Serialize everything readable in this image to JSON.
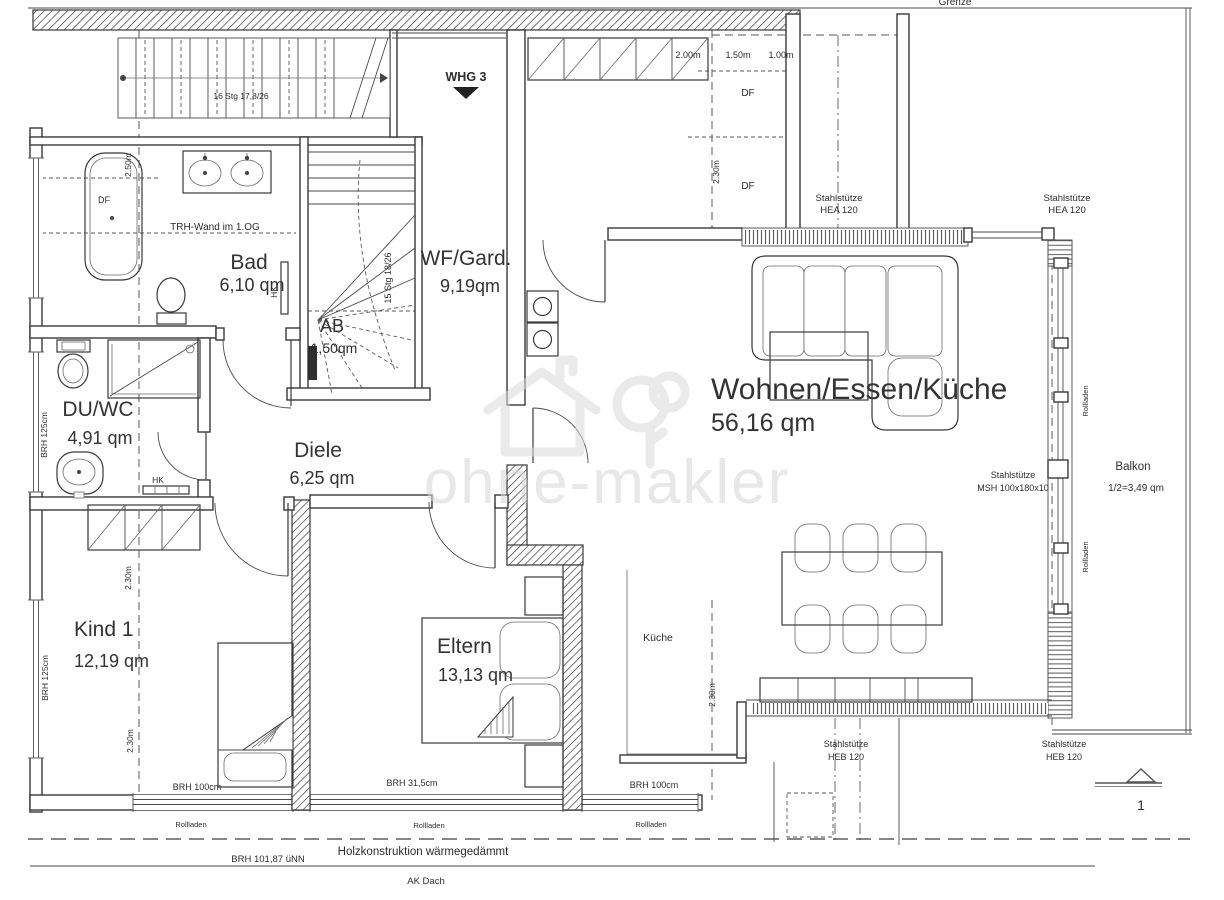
{
  "watermark": "ohne-makler",
  "entrance": {
    "label": "WHG 3"
  },
  "site": {
    "grenze": "Grenze"
  },
  "rooms": {
    "bad": {
      "name": "Bad",
      "area": "6,10 qm"
    },
    "wf_gard": {
      "name": "WF/Gard.",
      "area": "9,19qm"
    },
    "ab": {
      "name": "AB",
      "area": "1,50qm"
    },
    "du_wc": {
      "name": "DU/WC",
      "area": "4,91 qm"
    },
    "diele": {
      "name": "Diele",
      "area": "6,25 qm"
    },
    "wohnen_essen_kueche": {
      "name": "Wohnen/Essen/Küche",
      "area": "56,16 qm"
    },
    "kueche": {
      "name": "Küche"
    },
    "kind1": {
      "name": "Kind 1",
      "area": "12,19 qm"
    },
    "eltern": {
      "name": "Eltern",
      "area": "13,13 qm"
    },
    "balkon": {
      "name": "Balkon",
      "area": "1/2=3,49 qm"
    }
  },
  "stairs": {
    "upper": "16 Stg 17,8/26",
    "inner": "15 Stg 18/26"
  },
  "dimensions": {
    "d200": "2.00m",
    "d150": "1.50m",
    "d100": "1.00m",
    "d230": "2.30m",
    "d250": "2.50m"
  },
  "window_sills": {
    "brh125": "BRH 125cm",
    "brh100": "BRH 100cm",
    "brh315": "BRH 31,5cm",
    "brh_unn": "BRH 101,87 üNN"
  },
  "shutters": {
    "rollladen": "Rollladen"
  },
  "roof_windows": {
    "df": "DF"
  },
  "radiators": {
    "hk": "HK"
  },
  "columns": {
    "hea": {
      "line1": "Stahlstütze",
      "line2": "HEA 120"
    },
    "msh": {
      "line1": "Stahlstütze",
      "line2": "MSH 100x180x10"
    },
    "heb": {
      "line1": "Stahlstütze",
      "line2": "HEB 120"
    }
  },
  "notes": {
    "trh_wand": "TRH-Wand im 1.OG",
    "holzkonstruktion": "Holzkonstruktion wärmegedämmt",
    "ak_dach": "AK Dach"
  },
  "section_marker": {
    "number": "1"
  }
}
